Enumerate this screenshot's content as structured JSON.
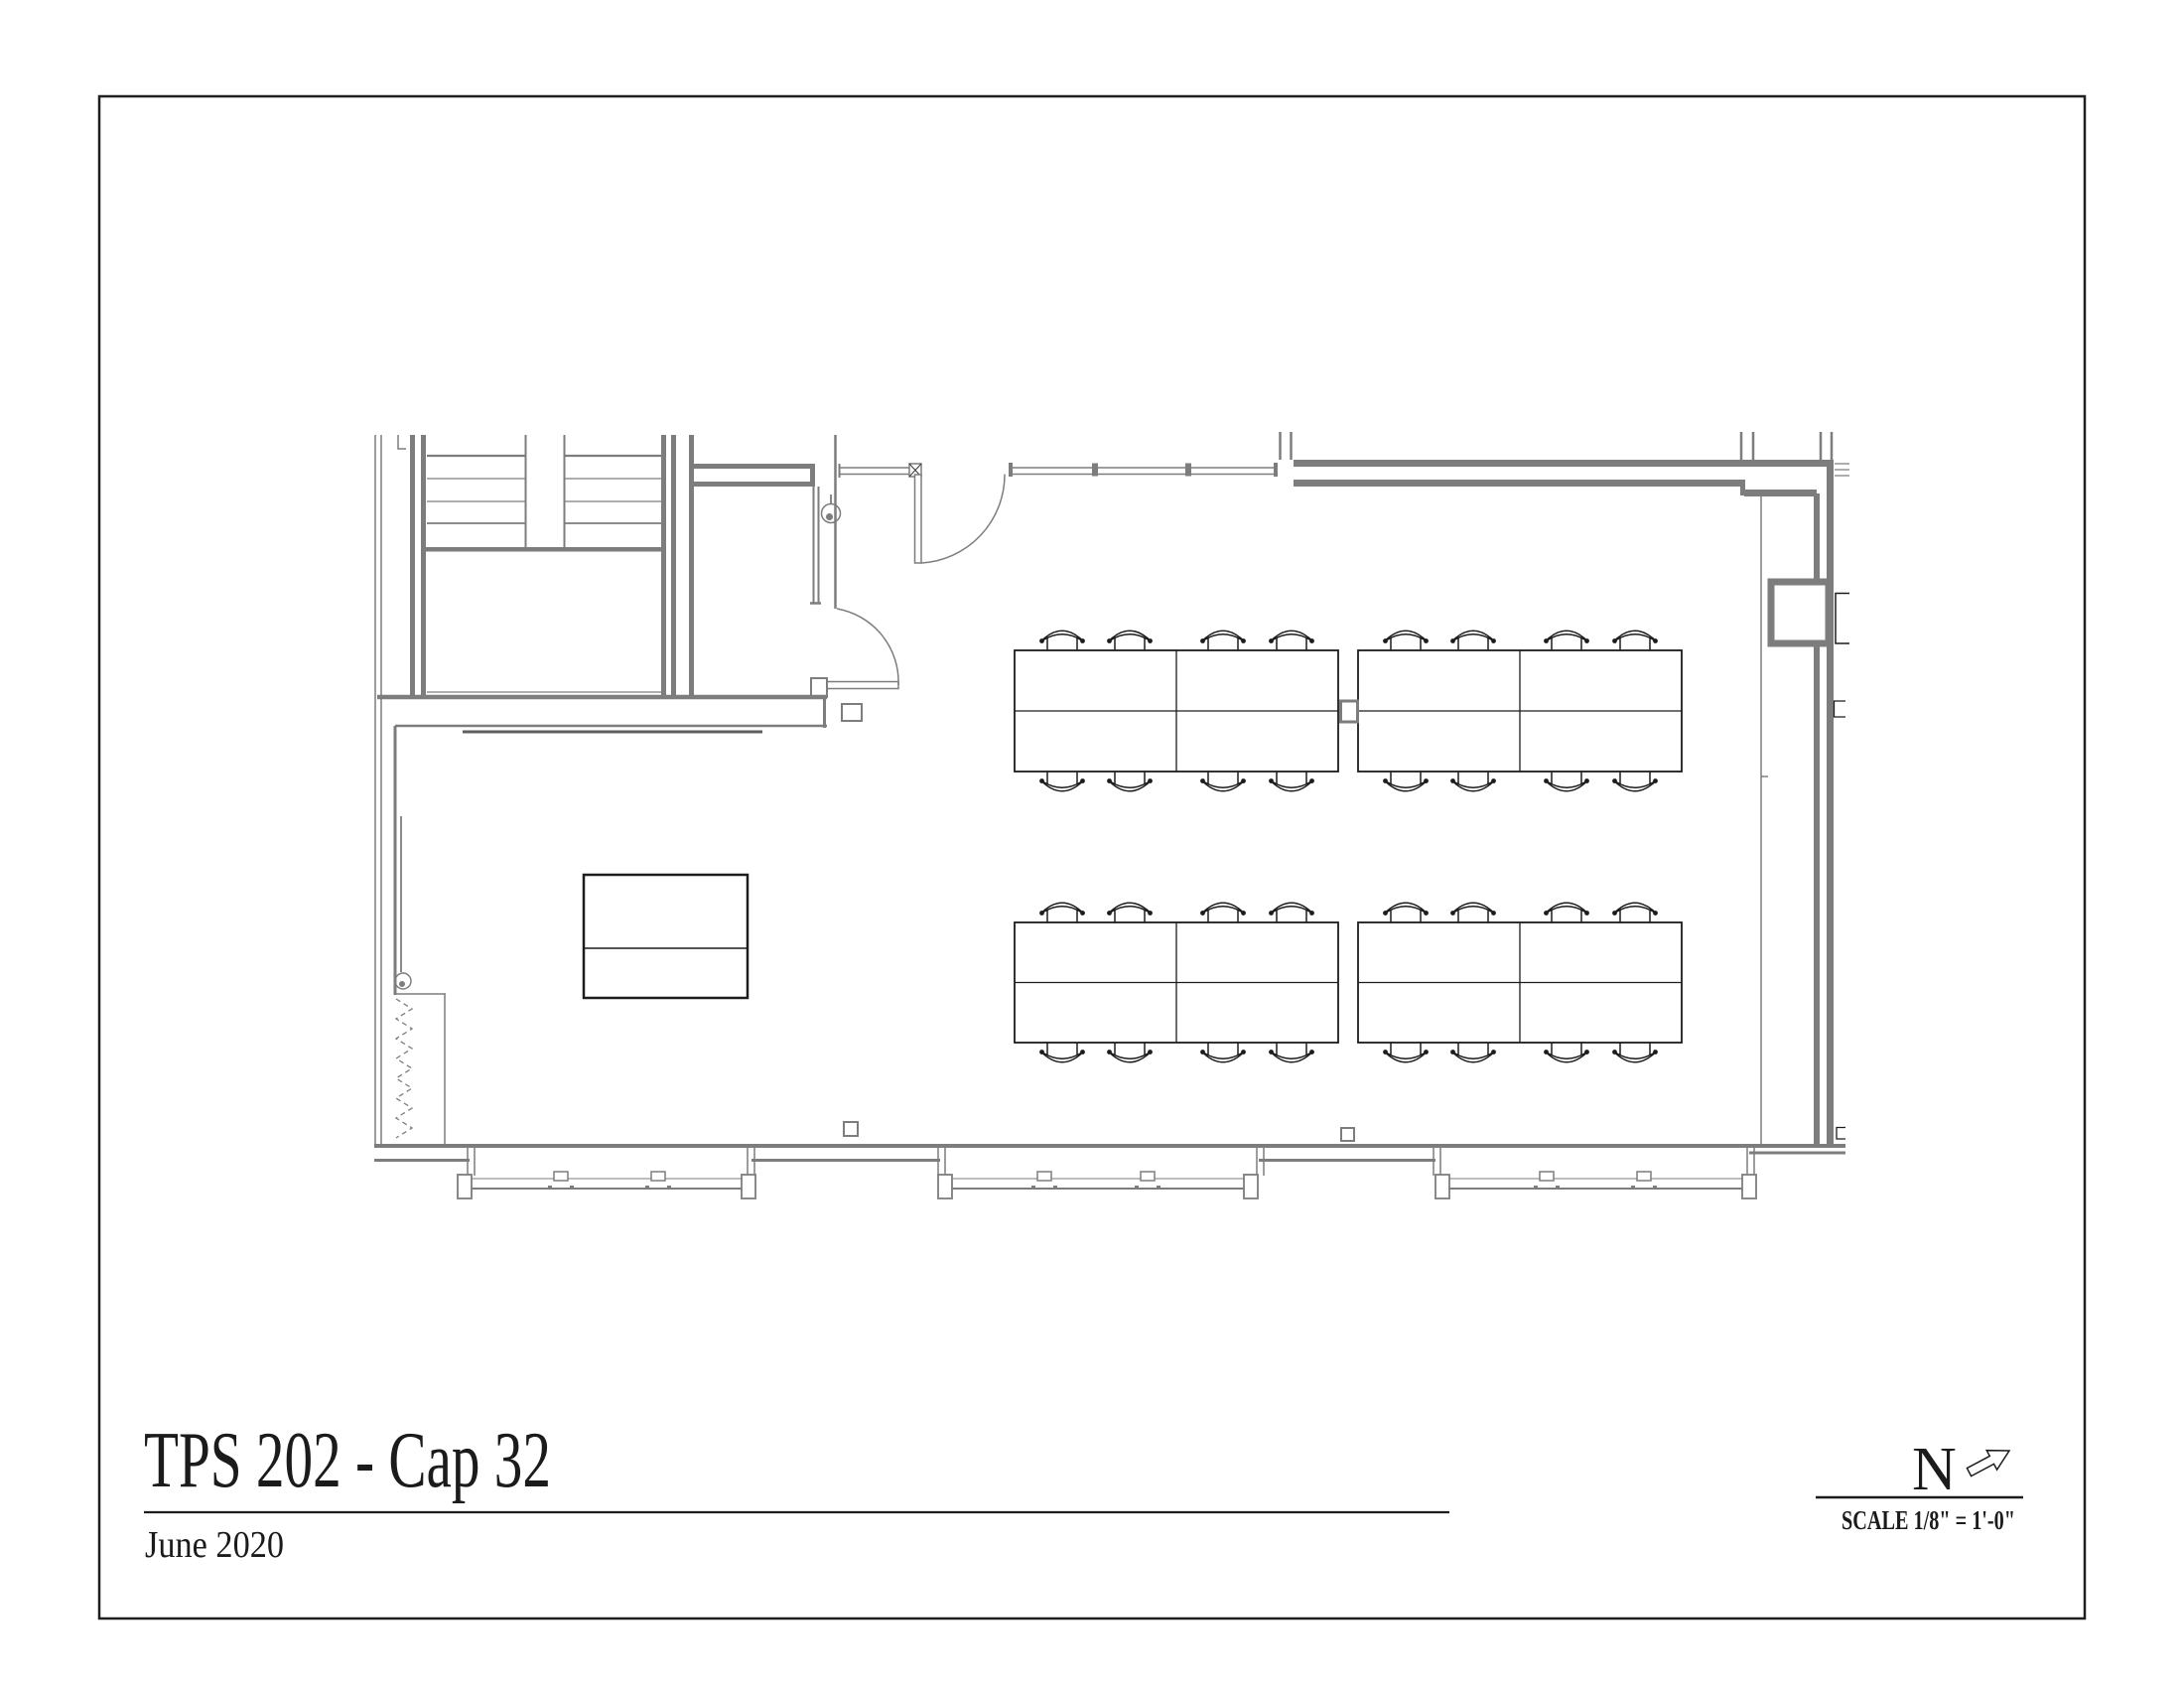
{
  "sheet": {
    "title": "TPS 202 - Cap 32",
    "date": "June 2020",
    "north_label": "N",
    "scale_label": "SCALE 1/8\" = 1'-0\""
  },
  "colors": {
    "wall_gray": "#7d7d7d",
    "furniture_black": "#1c1c1c",
    "paper": "#ffffff"
  },
  "plan": {
    "room_type": "classroom floor plan",
    "table_groups": 4,
    "chairs_total": 32,
    "doors": 2,
    "stair_flights": 2,
    "bottom_window_runs": 3,
    "top_window_mullions": 2
  }
}
